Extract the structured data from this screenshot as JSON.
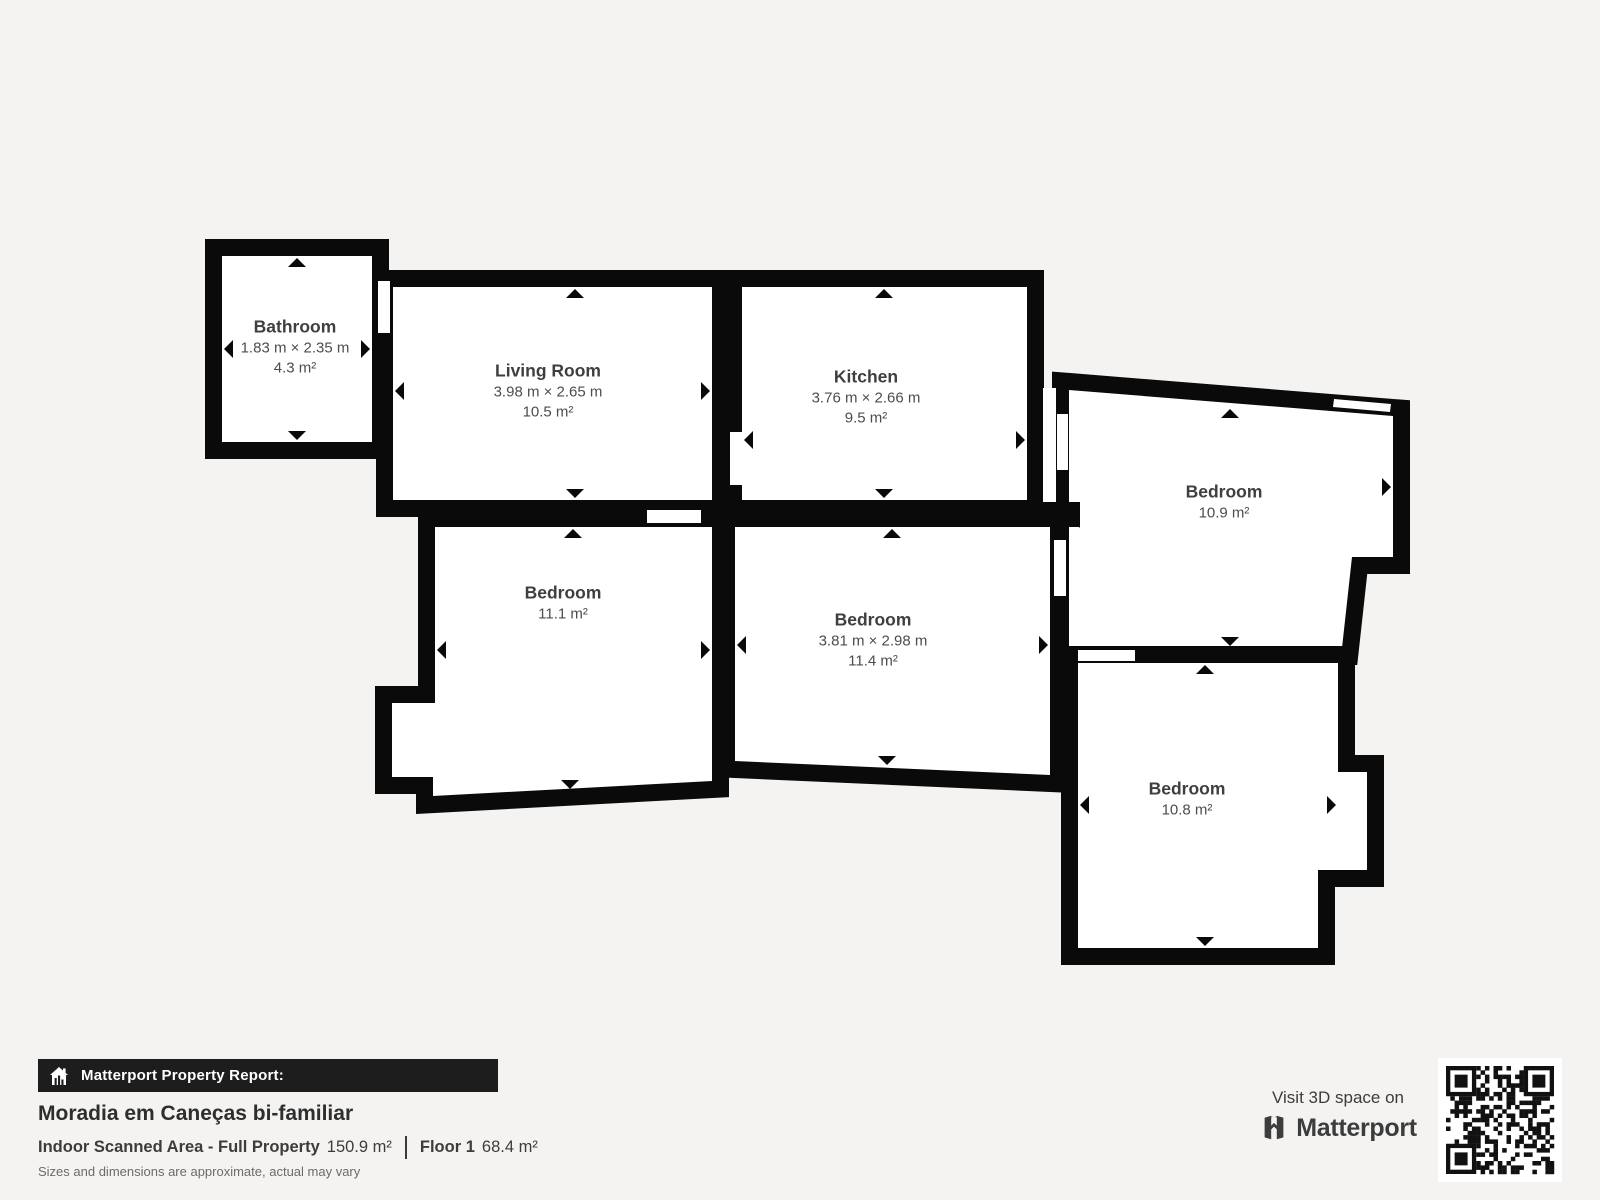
{
  "rooms": [
    {
      "id": "bathroom",
      "name": "Bathroom",
      "dims": "1.83 m × 2.35 m",
      "area": "4.3 m²"
    },
    {
      "id": "living-room",
      "name": "Living Room",
      "dims": "3.98 m × 2.65 m",
      "area": "10.5 m²"
    },
    {
      "id": "kitchen",
      "name": "Kitchen",
      "dims": "3.76 m × 2.66 m",
      "area": "9.5 m²"
    },
    {
      "id": "bedroom-right",
      "name": "Bedroom",
      "area": "10.9 m²"
    },
    {
      "id": "bedroom-left",
      "name": "Bedroom",
      "area": "11.1 m²"
    },
    {
      "id": "bedroom-middle",
      "name": "Bedroom",
      "dims": "3.81 m × 2.98 m",
      "area": "11.4 m²"
    },
    {
      "id": "bedroom-bottom-right",
      "name": "Bedroom",
      "area": "10.8 m²"
    }
  ],
  "report": {
    "banner": "Matterport Property Report:",
    "property_title": "Moradia em Caneças bi-familiar",
    "scanned_area_label": "Indoor Scanned Area - Full Property",
    "scanned_area_value": "150.9 m²",
    "floor_label": "Floor 1",
    "floor_value": "68.4 m²",
    "disclaimer": "Sizes and dimensions are approximate, actual may vary"
  },
  "branding": {
    "visit_text": "Visit 3D space on",
    "brand_name": "Matterport"
  },
  "icons": {
    "house_icon": "house-with-chart-bars",
    "qr_code": "qr-code",
    "matterport_mark": "matterport-logo-mark"
  },
  "colors": {
    "background": "#f4f3f1",
    "walls": "#0a0a0a",
    "room_fill": "#ffffff",
    "banner_bg": "#1d1d1d",
    "text_dark": "#2e2e2e",
    "text_mid": "#3f3f3f",
    "text_soft": "#6b6b6b"
  }
}
